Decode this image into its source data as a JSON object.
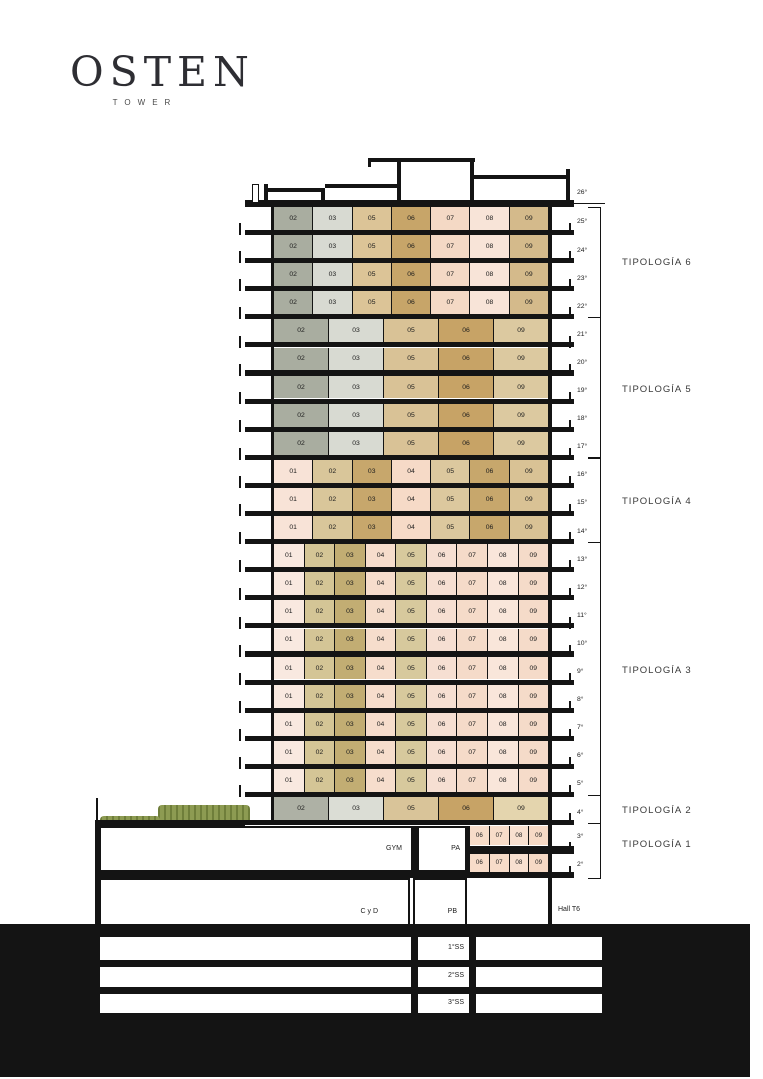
{
  "logo": {
    "title": "OSTEN",
    "subtitle": "TOWER"
  },
  "watermark": {
    "text": "TIZADO"
  },
  "roof": {
    "label": "26°"
  },
  "tower": {
    "groups": [
      {
        "typology": "TIPOLOGÍA 6",
        "floors": [
          "25°",
          "24°",
          "23°",
          "22°"
        ],
        "units": [
          "02",
          "03",
          "05",
          "06",
          "07",
          "08",
          "09"
        ],
        "colors": [
          "#a9ada0",
          "#d8dad2",
          "#dcc497",
          "#c7a569",
          "#f4d9c5",
          "#f8e4d8",
          "#d4ba8b"
        ]
      },
      {
        "typology": "TIPOLOGÍA 5",
        "floors": [
          "21°",
          "20°",
          "19°",
          "18°",
          "17°"
        ],
        "units": [
          "02",
          "03",
          "05",
          "06",
          "09"
        ],
        "colors": [
          "#a9ada0",
          "#d8dad2",
          "#d9c296",
          "#c7a366",
          "#dcc9a0"
        ]
      },
      {
        "typology": "TIPOLOGÍA 4",
        "floors": [
          "16°",
          "15°",
          "14°"
        ],
        "units": [
          "01",
          "02",
          "03",
          "04",
          "05",
          "06",
          "09"
        ],
        "colors": [
          "#f8e3d7",
          "#d9c69a",
          "#c7a76c",
          "#f6dac7",
          "#dcc89e",
          "#c7a76c",
          "#d9c295"
        ]
      },
      {
        "typology": "TIPOLOGÍA 3",
        "floors": [
          "13°",
          "12°",
          "11°",
          "10°",
          "9°",
          "8°",
          "7°",
          "6°",
          "5°"
        ],
        "units": [
          "01",
          "02",
          "03",
          "04",
          "05",
          "06",
          "07",
          "08",
          "09"
        ],
        "colors": [
          "#f9e9e0",
          "#d4c596",
          "#c2ad73",
          "#f6ddcc",
          "#d7c99d",
          "#f6dfd2",
          "#f5dbc9",
          "#f9e6da",
          "#f5dbc9"
        ]
      },
      {
        "typology": "TIPOLOGÍA 2",
        "floors": [
          "4°"
        ],
        "units": [
          "02",
          "03",
          "05",
          "06",
          "09"
        ],
        "colors": [
          "#aeb1a5",
          "#dbddd5",
          "#d9c499",
          "#c7a366",
          "#e4d5ae"
        ]
      }
    ],
    "tipologia1": {
      "typology": "TIPOLOGÍA 1",
      "floors": [
        "3°",
        "2°"
      ],
      "units": [
        "06",
        "07",
        "08",
        "09"
      ],
      "colors": [
        "#f7dcc9",
        "#f7dcc9",
        "#f8e0d0",
        "#f6d9c5"
      ]
    }
  },
  "base": {
    "gym": "GYM",
    "pa": "PA",
    "cyd": "C y D",
    "pb": "PB",
    "hall": "Hall T6",
    "basements": [
      "1°SS",
      "2°SS",
      "3°SS"
    ]
  }
}
